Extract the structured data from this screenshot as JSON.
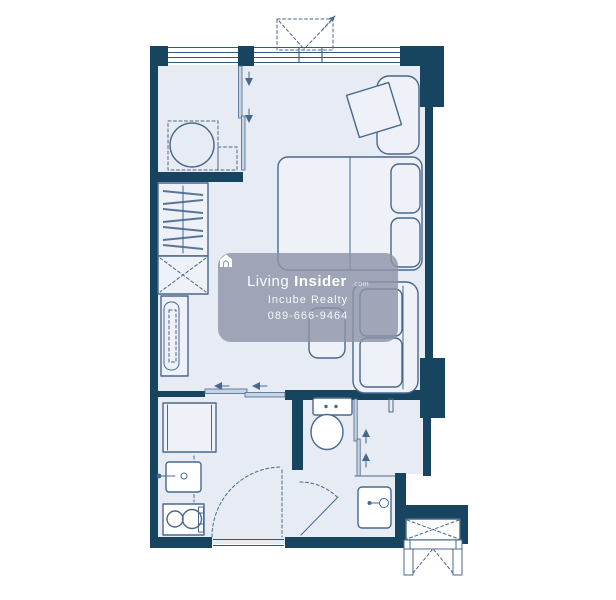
{
  "palette": {
    "wall": "#17455f",
    "floor": "#e7ecf4",
    "line": "#48688d",
    "furniture-fill": "#eef1f8",
    "window-line": "#35597a",
    "track-fill": "#c9d4e3",
    "watermark-bg": "rgba(143,148,168,0.82)",
    "watermark-text": "#ffffff",
    "background": "#ffffff"
  },
  "watermark": {
    "icon": "house-logo-icon",
    "brand_light": "Living",
    "brand_bold": "Insider",
    "brand_suffix": ".com",
    "agency": "Incube Realty",
    "phone": "089-666-9464"
  },
  "floorplan": {
    "type": "studio-condo-unit-plan",
    "rooms": [
      "utility-room",
      "bedroom-living-area",
      "kitchen",
      "bathroom",
      "ac-ledge"
    ],
    "furniture": [
      "washing-machine",
      "wardrobe-hangers",
      "shelf-cabinet",
      "tv-console",
      "bed",
      "pillows",
      "tilted-desk",
      "lounge-chair",
      "sofa",
      "side-table",
      "refrigerator",
      "kitchen-sink",
      "two-burner-stove",
      "toilet",
      "shower-enclosure",
      "bathroom-sink",
      "entry-door-swing",
      "bathroom-door-swing",
      "sliding-doors",
      "casement-window",
      "ac-condenser-louver"
    ]
  }
}
